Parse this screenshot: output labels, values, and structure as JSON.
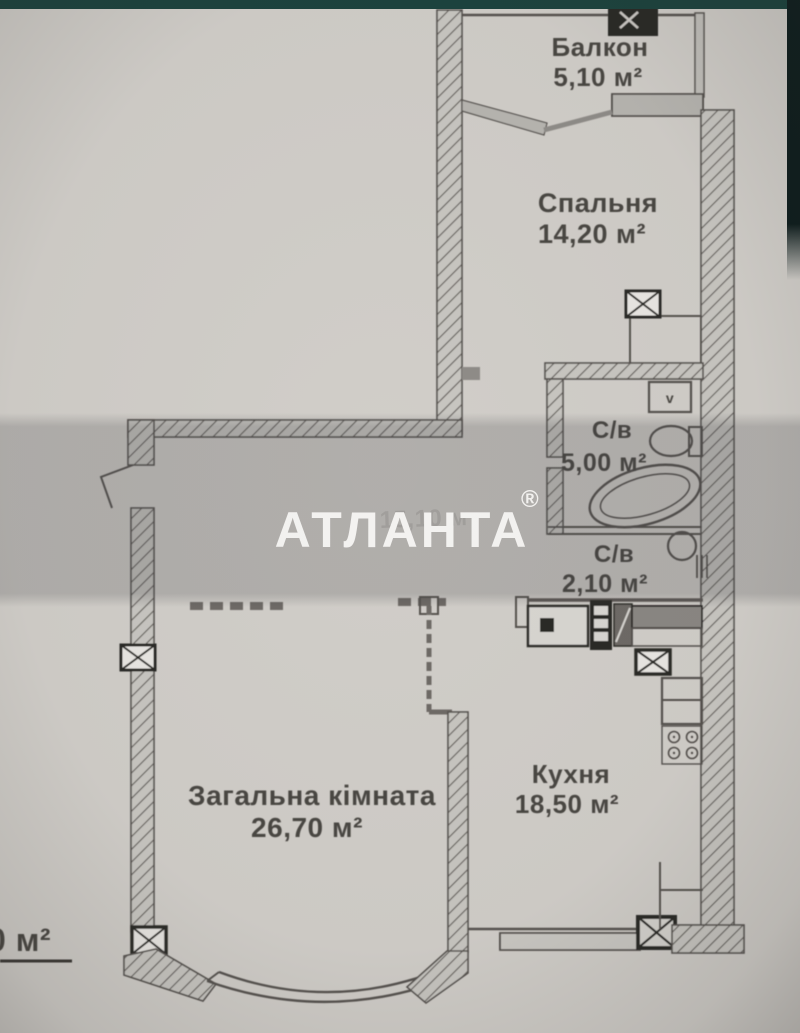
{
  "watermark": {
    "brand": "АТЛАНТА",
    "registered": "®"
  },
  "rooms": {
    "balcony": {
      "name": "Балкон",
      "area": "5,10 м²"
    },
    "bedroom": {
      "name": "Спальня",
      "area": "14,20 м²"
    },
    "bathroom": {
      "name": "С/в",
      "area": "5,00 м²"
    },
    "wc": {
      "name": "С/в",
      "area": "2,10 м²"
    },
    "living": {
      "name": "Загальна кімната",
      "area": "26,70 м²"
    },
    "kitchen": {
      "name": "Кухня",
      "area": "18,50 м²"
    }
  },
  "hall_faint": {
    "label": "15,10 м"
  },
  "total_area_fragment": {
    "text": "0 м²"
  },
  "fixtures": {
    "washer_label": "v"
  },
  "colors": {
    "paper": "#d1cec9",
    "band_overlay": "#3e3e42",
    "ink": "#4a4643",
    "wall": "#56524f",
    "dark": "#2b2927",
    "teal_strip": "#1c433e",
    "edge_dark": "#0e1d1d",
    "watermark_white": "#f4f3f1"
  }
}
